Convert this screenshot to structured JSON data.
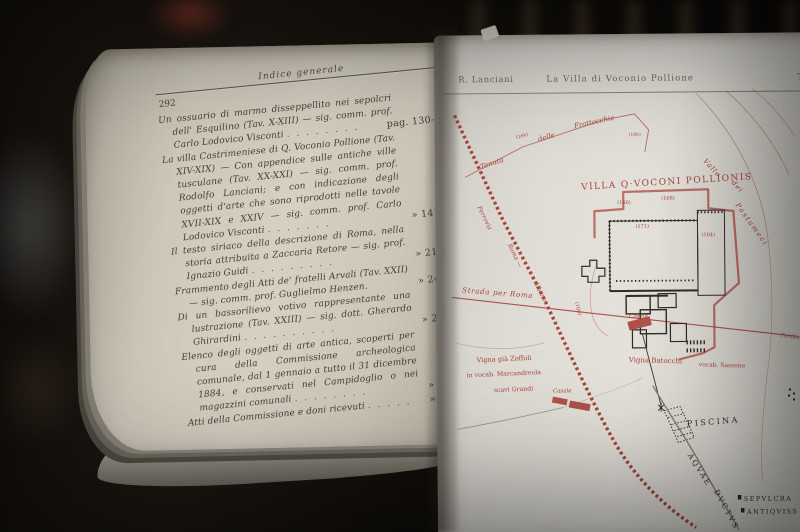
{
  "colors": {
    "red_ink": "#a8453b",
    "black_ink": "#36312b",
    "paper_left": "#cfc9bb",
    "paper_right": "#e0ddd6"
  },
  "left_page": {
    "page_number": "292",
    "header": "Indice generale",
    "entries": [
      {
        "text": "Un ossuario di marmo disseppellito nei sepolcri dell' Esquilino (Tav. X-XIII) — sig. comm. prof. Carlo Lodovico Visconti",
        "leader": ". . . . . . . .",
        "ref": "pag. 130-140"
      },
      {
        "text": "La villa Castrimeniese di Q. Voconio Pollione (Tav. XIV-XIX) — Con appendice sulle antiche ville tusculane (Tav. XX-XXI) — sig. comm. prof. Rodolfo Lanciani; e con indicazione degli oggetti d'arte che sono riprodotti nelle tavole XVII-XIX e XXIV — sig. comm. prof. Carlo Lodovico Visconti",
        "leader": ". . . . . . .",
        "ref": "» 141-217"
      },
      {
        "text": "Il testo siriaco della descrizione di Roma, nella storia attribuita a Zaccaria Retore — sig. prof. Ignazio Guidi",
        "leader": ". . . . . . . . .",
        "ref": "» 218-239"
      },
      {
        "text": "Frammento degli Atti de' fratelli Arvali (Tav. XXII) — sig. comm. prof. Guglielmo Henzen.",
        "leader": "",
        "ref": "» 240-244"
      },
      {
        "text": "Di un bassorilievo votivo rappresentante una lustrazione (Tav. XXIII) — sig. dott. Gherardo Ghirardini",
        "leader": ". . . . . . . . . .",
        "ref": "» 245-253"
      },
      {
        "text": "Elenco degli oggetti di arte antica, scoperti per cura della Commissione archeologica comunale, dal 1 gennaio a tutto il 31 dicembre 1884, e conservati nel Campidoglio o nei magazzini comunali",
        "leader": ". . . . . . . .",
        "ref": "» 254-281"
      },
      {
        "text": "Atti della Commissione e doni ricevuti",
        "leader": ". . . . .",
        "ref": "» 282-288"
      }
    ]
  },
  "right_page": {
    "running_author": "R. Lanciani",
    "running_title": "La Villa di Voconio Pollione",
    "running_right": "T",
    "map": {
      "villa_title": "VILLA Q·VOCONI POLLIONIS",
      "tenuta_1": "Tenuta",
      "tenuta_2": "delle",
      "tenuta_3": "Frattocchie",
      "valle_1": "Valle",
      "valle_2": "dei",
      "valle_3": "Pastumeci",
      "ferrovia_1": "Ferrovia",
      "ferrovia_2": "Roma —",
      "ferrovia_3": "Albano",
      "strada": "Strada per Roma",
      "casale_1": "Casale",
      "casale_2": "Casale",
      "zoffoli_1": "Vigna già Zoffoli",
      "zoffoli_2": "in vocab. Marcandreola",
      "zoffoli_3": "scavi Grandi",
      "batocchi_1": "Vigna Batocchi",
      "batocchi_2": "vocab. Sassone",
      "fontanile": "Fontan",
      "piscina": "PISCINA",
      "aquae_1": "AQVAE",
      "aquae_2": "DVCTVS",
      "sepulcra_1": "SEPVLCRA",
      "sepulcra_2": "ANTIQVISS",
      "elev_line_a": "(166)",
      "elev_line_b": "(166)",
      "elev_1": "(166)",
      "elev_2": "(168)",
      "elev_3": "(171)",
      "elev_4": "(164)",
      "elev_5": "(160)"
    }
  }
}
